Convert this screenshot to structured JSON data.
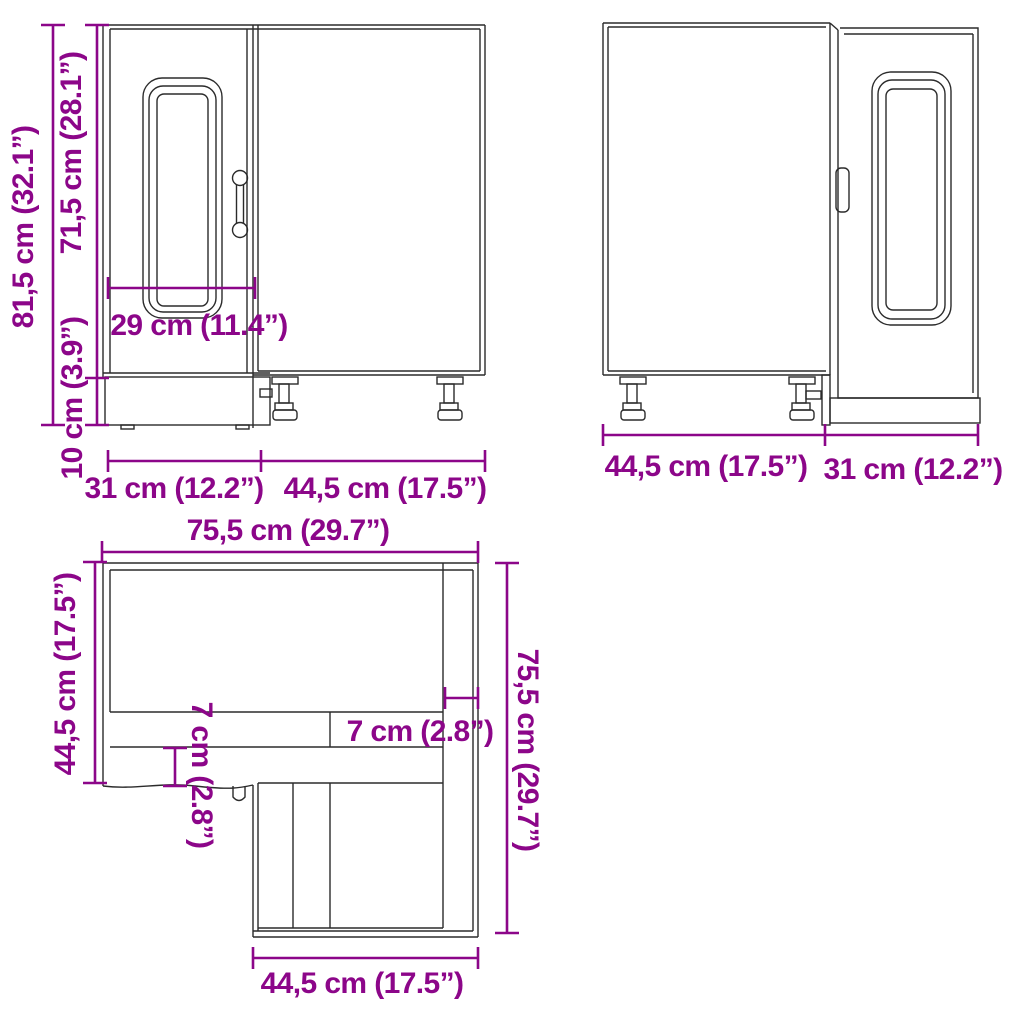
{
  "colors": {
    "dimension_accent": "#8C0689",
    "line": "#2B2B2B",
    "background": "#FFFFFF"
  },
  "views": {
    "front": {
      "title": "front-view-of-corner-base-cabinet",
      "labels": {
        "total_height": "81,5 cm (32.1”)",
        "door_height": "71,5 cm (28.1”)",
        "plinth_height": "10 cm (3.9”)",
        "door_width": "29 cm (11.4”)",
        "width_left": "31 cm (12.2”)",
        "width_right": "44,5 cm (17.5”)"
      }
    },
    "back": {
      "title": "side-back-view-of-corner-base-cabinet",
      "labels": {
        "width_left": "44,5 cm (17.5”)",
        "width_right": "31 cm (12.2”)"
      }
    },
    "top": {
      "title": "top-view-of-corner-base-cabinet",
      "labels": {
        "total_width": "75,5 cm (29.7”)",
        "side_depth": "44,5 cm (17.5”)",
        "total_depth": "75,5 cm (29.7”)",
        "overhang_left": "7 cm (2.8”)",
        "overhang_right": "7 cm (2.8”)",
        "wing_width": "44,5 cm (17.5”)"
      }
    }
  }
}
